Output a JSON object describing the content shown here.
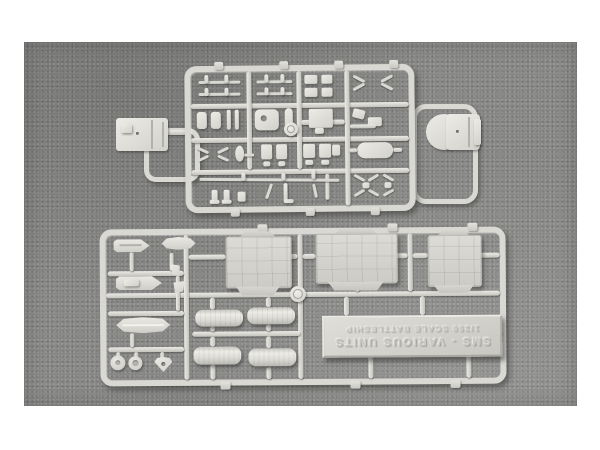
{
  "colors": {
    "page_background": "#ffffff",
    "photo_background": "#8d8d8b",
    "plastic": "#d9d8d2"
  },
  "nameplate": {
    "line1": "SMS - VARIOUS UNITS",
    "line2": "1/350 SCALE BATTLESHIP"
  },
  "scene": {
    "sprue_count": 2,
    "deck_panel_count": 3,
    "funnel_half_count": 4,
    "boat_hull_count": 4,
    "propeller_disc_count": 2
  }
}
